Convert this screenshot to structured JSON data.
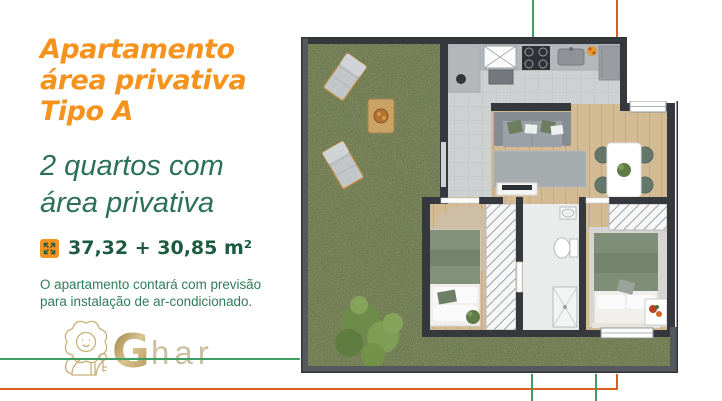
{
  "panel": {
    "title_lines": [
      "Apartamento",
      "área privativa",
      "Tipo A"
    ],
    "subtitle_lines": [
      "2 quartos com",
      "área privativa"
    ],
    "area_text": "37,32 + 30,85 m²",
    "note_lines": [
      "O apartamento contará com previsão",
      "para instalação de ar-condicionado."
    ],
    "brand": {
      "initial": "G",
      "rest": "har"
    }
  },
  "icons": {
    "area_icon": "area-dimensions-icon",
    "logo_icon": "lion-with-key-icon"
  },
  "colors": {
    "title_orange": "#F6921E",
    "subtitle_green": "#2B7157",
    "area_green": "#1D5B41",
    "note_green": "#2E7C5A",
    "logo_gold": "#C9B07A",
    "guide_line_green": "#3E9D62",
    "guide_line_orange": "#D8611F",
    "plan_wall": "#35383D",
    "plan_frame": "#55595E",
    "plan_grass": "#5E6940",
    "plan_wood_floor": "#D3BB96",
    "plan_tile_floor": "#CDD1D2"
  }
}
